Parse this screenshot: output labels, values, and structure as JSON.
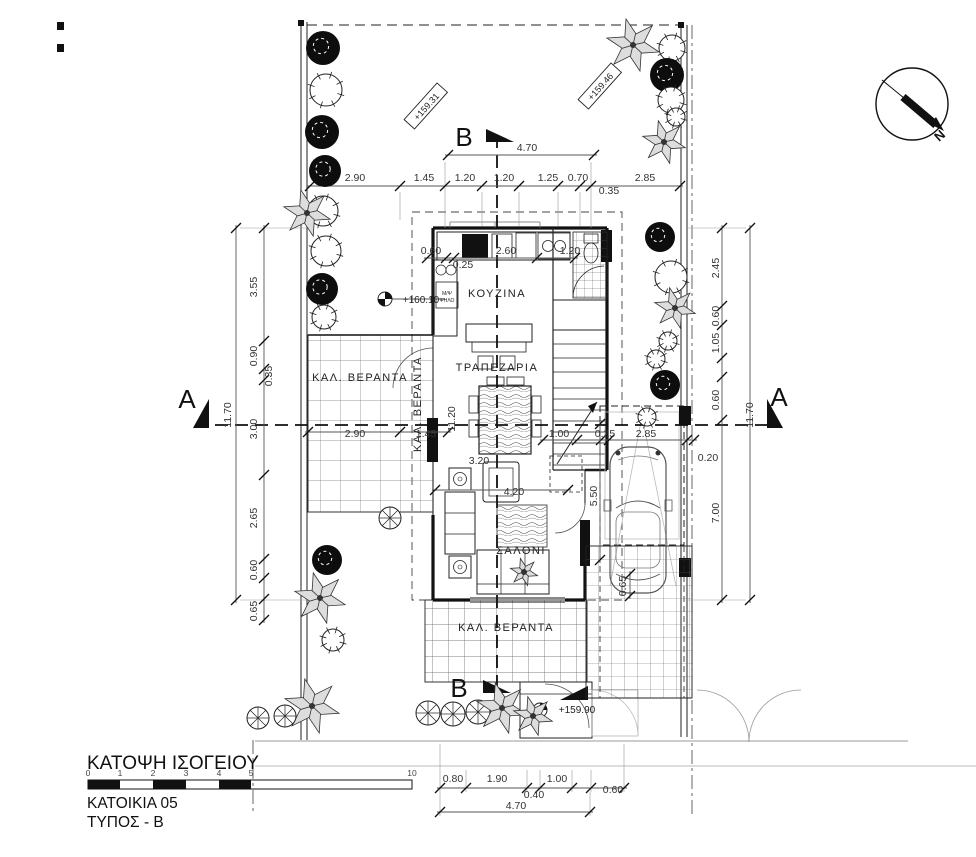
{
  "title_block": {
    "plan_title": "ΚΑΤΟΨΗ ΙΣΟΓΕΙΟΥ",
    "house_label": "ΚΑΤΟΙΚΙΑ 05",
    "type_label": "ΤΥΠΟΣ - Β",
    "scale_ticks": [
      "0",
      "1",
      "2",
      "3",
      "4",
      "5",
      "10"
    ]
  },
  "compass": {
    "north_label": "N"
  },
  "rooms": [
    "ΚΟΥΖΙΝΑ",
    "ΤΡΑΠΕΖΑΡΙΑ",
    "ΣΑΛΟΝΙ",
    "ΚΑΛ. ΒΕΡΑΝΤΑ"
  ],
  "labels": [
    {
      "t": "2.90",
      "x": 355,
      "y": 181,
      "cls": "dim"
    },
    {
      "t": "1.45",
      "x": 424,
      "y": 181,
      "cls": "dim"
    },
    {
      "t": "1.20",
      "x": 465,
      "y": 181,
      "cls": "dim"
    },
    {
      "t": "1.20",
      "x": 504,
      "y": 181,
      "cls": "dim"
    },
    {
      "t": "1.25",
      "x": 548,
      "y": 181,
      "cls": "dim"
    },
    {
      "t": "0.70",
      "x": 578,
      "y": 181,
      "cls": "dim"
    },
    {
      "t": "0.35",
      "x": 609,
      "y": 194,
      "cls": "dim"
    },
    {
      "t": "2.85",
      "x": 645,
      "y": 181,
      "cls": "dim"
    },
    {
      "t": "4.70",
      "x": 527,
      "y": 151,
      "cls": "dim"
    },
    {
      "t": "0.60",
      "x": 431,
      "y": 254,
      "cls": "dim"
    },
    {
      "t": "0.25",
      "x": 463,
      "y": 268,
      "cls": "dim"
    },
    {
      "t": "2.60",
      "x": 506,
      "y": 254,
      "cls": "dim"
    },
    {
      "t": "1.20",
      "x": 570,
      "y": 254,
      "cls": "dim"
    },
    {
      "t": "3.55",
      "x": 257,
      "y": 287,
      "cls": "dim",
      "r": -90
    },
    {
      "t": "0.90",
      "x": 257,
      "y": 356,
      "cls": "dim",
      "r": -90
    },
    {
      "t": "0.35",
      "x": 272,
      "y": 376,
      "cls": "dim",
      "r": -90
    },
    {
      "t": "3.00",
      "x": 257,
      "y": 429,
      "cls": "dim",
      "r": -90
    },
    {
      "t": "2.65",
      "x": 257,
      "y": 518,
      "cls": "dim",
      "r": -90
    },
    {
      "t": "0.60",
      "x": 257,
      "y": 570,
      "cls": "dim",
      "r": -90
    },
    {
      "t": "0.65",
      "x": 257,
      "y": 611,
      "cls": "dim",
      "r": -90
    },
    {
      "t": "11.70",
      "x": 231,
      "y": 415,
      "cls": "dim",
      "r": -90
    },
    {
      "t": "2.45",
      "x": 719,
      "y": 268,
      "cls": "dim",
      "r": -90
    },
    {
      "t": "0.60",
      "x": 719,
      "y": 316,
      "cls": "dim",
      "r": -90
    },
    {
      "t": "1.05",
      "x": 719,
      "y": 343,
      "cls": "dim",
      "r": -90
    },
    {
      "t": "0.60",
      "x": 719,
      "y": 400,
      "cls": "dim",
      "r": -90
    },
    {
      "t": "7.00",
      "x": 719,
      "y": 513,
      "cls": "dim",
      "r": -90
    },
    {
      "t": "11.70",
      "x": 753,
      "y": 415,
      "cls": "dim",
      "r": -90
    },
    {
      "t": "0.20",
      "x": 708,
      "y": 461,
      "cls": "dim"
    },
    {
      "t": "2.90",
      "x": 355,
      "y": 437,
      "cls": "dim"
    },
    {
      "t": "1.45",
      "x": 426,
      "y": 437,
      "cls": "dim"
    },
    {
      "t": "1.00",
      "x": 559,
      "y": 437,
      "cls": "dim"
    },
    {
      "t": "0.25",
      "x": 605,
      "y": 437,
      "cls": "dim"
    },
    {
      "t": "2.85",
      "x": 646,
      "y": 437,
      "cls": "dim"
    },
    {
      "t": "11.20",
      "x": 455,
      "y": 419,
      "cls": "dim",
      "r": -90
    },
    {
      "t": "3.20",
      "x": 479,
      "y": 464,
      "cls": "dim"
    },
    {
      "t": "4.20",
      "x": 514,
      "y": 495,
      "cls": "dim"
    },
    {
      "t": "5.50",
      "x": 597,
      "y": 496,
      "cls": "dim",
      "r": -90
    },
    {
      "t": "0.65",
      "x": 626,
      "y": 586,
      "cls": "dim",
      "r": -90
    },
    {
      "t": "0.80",
      "x": 453,
      "y": 782,
      "cls": "dim"
    },
    {
      "t": "1.90",
      "x": 497,
      "y": 782,
      "cls": "dim"
    },
    {
      "t": "0.40",
      "x": 534,
      "y": 798,
      "cls": "dim"
    },
    {
      "t": "1.00",
      "x": 557,
      "y": 782,
      "cls": "dim"
    },
    {
      "t": "0.60",
      "x": 613,
      "y": 793,
      "cls": "dim"
    },
    {
      "t": "4.70",
      "x": 516,
      "y": 809,
      "cls": "dim"
    },
    {
      "t": "ΚΟΥΖΙΝΑ",
      "x": 497,
      "y": 297,
      "cls": "room"
    },
    {
      "t": "ΤΡΑΠΕΖΑΡΙΑ",
      "x": 497,
      "y": 371,
      "cls": "room"
    },
    {
      "t": "ΣΑΛΟΝΙ",
      "x": 521,
      "y": 554,
      "cls": "room"
    },
    {
      "t": "ΚΑΛ. ΒΕΡΑΝΤΑ",
      "x": 360,
      "y": 381,
      "cls": "room"
    },
    {
      "t": "ΚΑΛ. ΒΕΡΑΝΤΑ",
      "x": 421,
      "y": 404,
      "cls": "room",
      "r": -90
    },
    {
      "t": "ΚΑΛ. ΒΕΡΑΝΤΑ",
      "x": 506,
      "y": 631,
      "cls": "room"
    },
    {
      "t": "A",
      "x": 187,
      "y": 408,
      "cls": "sec"
    },
    {
      "t": "A",
      "x": 779,
      "y": 406,
      "cls": "sec"
    },
    {
      "t": "B",
      "x": 464,
      "y": 146,
      "cls": "sec"
    },
    {
      "t": "B",
      "x": 459,
      "y": 697,
      "cls": "sec"
    },
    {
      "t": "+160.10",
      "x": 421,
      "y": 303,
      "cls": "elev"
    },
    {
      "t": "+159.90",
      "x": 577,
      "y": 713,
      "cls": "elev"
    },
    {
      "t": "+159.31",
      "x": 428,
      "y": 108,
      "cls": "elevbox",
      "r": -48
    },
    {
      "t": "+159.46",
      "x": 602,
      "y": 88,
      "cls": "elevbox",
      "r": -48
    },
    {
      "t": "Μ/Ψ",
      "x": 447,
      "y": 295,
      "cls": "note"
    },
    {
      "t": "ΨΗΛΟ",
      "x": 447,
      "y": 302,
      "cls": "note"
    }
  ]
}
